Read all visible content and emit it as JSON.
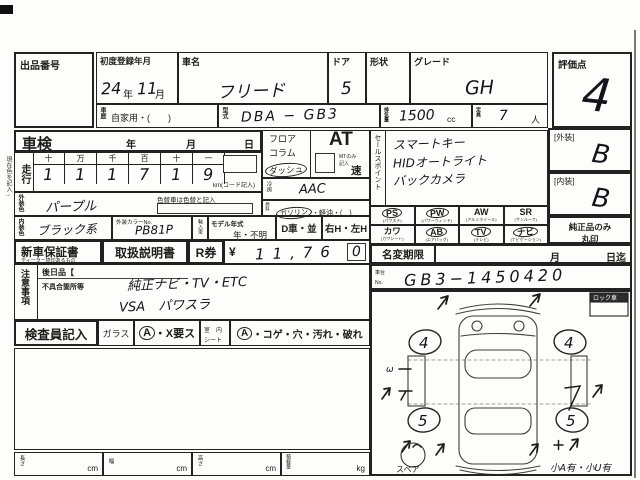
{
  "colors": {
    "paper": "#fdfdfb",
    "ink": "#1a1a1a",
    "pen": "#14141c"
  },
  "margin_note": "現在色を記入→",
  "header": {
    "lot_label": "出品番号",
    "first_reg": {
      "label": "初度登録年月",
      "year": "24",
      "year_unit": "年",
      "month": "11",
      "month_unit": "月"
    },
    "car_name": {
      "label": "車名",
      "value": "フリード"
    },
    "door": {
      "label": "ドア",
      "value": "5"
    },
    "shape": {
      "label": "形状",
      "value": ""
    },
    "grade": {
      "label": "グレード",
      "value": "GH"
    },
    "score": {
      "label": "評価点",
      "value": "4"
    },
    "history": {
      "label": "車歴",
      "value": "自家用・(　　)"
    },
    "model_code": {
      "label": "型式",
      "value": "DBA − GB3"
    },
    "displacement": {
      "label": "排気量",
      "value": "1500",
      "unit": "cc"
    },
    "capacity": {
      "label": "定員",
      "value": "7",
      "unit": "人"
    }
  },
  "shaken": {
    "label": "車検",
    "units": {
      "y": "年",
      "m": "月",
      "d": "日"
    }
  },
  "mileage": {
    "label": "走行",
    "place_headers": [
      "十",
      "万",
      "千",
      "百",
      "十",
      "一"
    ],
    "digits": [
      "1",
      "1",
      "1",
      "7",
      "1",
      "9"
    ],
    "unit_note": "km(コード記入)"
  },
  "ext_color": {
    "label": "外装色",
    "value": "パープル",
    "recolor_note": "色替車は色替と記入"
  },
  "int_color": {
    "label": "内装色",
    "value": "ブラック系"
  },
  "color_no": {
    "label": "外装カラーNo.",
    "value": "PB81P"
  },
  "import_car": {
    "label": "輸入車"
  },
  "model_year": {
    "label": "モデル年式",
    "value": "年・不明"
  },
  "d_car": "D車・並",
  "handle": "右H・左H",
  "warranty": {
    "label": "新車保証書",
    "sub": "ディーラー捺印あるもの"
  },
  "manual_label": "取扱説明書",
  "rken": {
    "label": "R券",
    "yen": "¥",
    "amount": "11,76",
    "amount_boxed": "0"
  },
  "notes": {
    "label": "注意事項",
    "later_label": "後日品【",
    "defect_label": "不具合箇所等",
    "line1": "純正ナビ・TV・ETC",
    "line2": "VSA　パワスラ"
  },
  "inspector": {
    "label": "検査員記入",
    "glass_label": "ガラス",
    "glass_circled": "A",
    "glass_rest": "・X要ス",
    "seat_label1": "室　内",
    "seat_label2": "シート",
    "seat_circled": "A",
    "seat_rest": "・コゲ・穴・汚れ・破れ"
  },
  "dims": {
    "items": [
      {
        "label": "長さ",
        "unit": "cm"
      },
      {
        "label": "幅",
        "unit": "cm"
      },
      {
        "label": "高さ",
        "unit": "cm"
      },
      {
        "label": "積載量",
        "unit": "kg"
      }
    ]
  },
  "shift": {
    "options": [
      "フロア",
      "コラム",
      "ダッシュ"
    ],
    "circled": "ダッシュ",
    "at_label": "AT",
    "mt_note": "MTのみ記入",
    "speed": "速"
  },
  "ac": {
    "label": "冷房",
    "value": "AAC"
  },
  "fuel": {
    "label": "燃料",
    "first": "ガソリン",
    "rest": "・軽油・(　)"
  },
  "sales": {
    "label": "セールスポイント",
    "lines": [
      "スマートキー",
      "HIDオートライト",
      "バックカメラ"
    ]
  },
  "equip": {
    "items": [
      {
        "label": "PS",
        "paren": "(パワステ)",
        "circled": true
      },
      {
        "label": "PW",
        "paren": "(パワーウィンド)",
        "circled": true
      },
      {
        "label": "AW",
        "paren": "(アルミホイール)",
        "circled": false
      },
      {
        "label": "SR",
        "paren": "(サンルーフ)",
        "circled": false
      },
      {
        "label": "カワ",
        "paren": "(カワシート)",
        "circled": false
      },
      {
        "label": "AB",
        "paren": "(エアバッグ)",
        "circled": true
      },
      {
        "label": "TV",
        "paren": "(テレビ)",
        "circled": true
      },
      {
        "label": "ナビ",
        "paren": "(ナビゲーション)",
        "circled": true
      }
    ]
  },
  "name_change": {
    "label": "名変期限",
    "month": "月",
    "day": "日迄"
  },
  "chassis": {
    "label1": "車台",
    "label2": "No.",
    "value": "GB3−1450420"
  },
  "right_panel": {
    "exterior_label": "[外装]",
    "exterior_value": "B",
    "interior_label": "[内装]",
    "interior_value": "B",
    "genuine_line1": "純正品のみ",
    "genuine_line2": "丸印"
  },
  "diagram": {
    "lock_label": "ロック車",
    "spare_label": "スペア",
    "note": "小A有・小U有",
    "wheel_fl": "4",
    "wheel_fr": "4",
    "wheel_rl": "5",
    "wheel_rr": "5",
    "omega": "ω"
  }
}
